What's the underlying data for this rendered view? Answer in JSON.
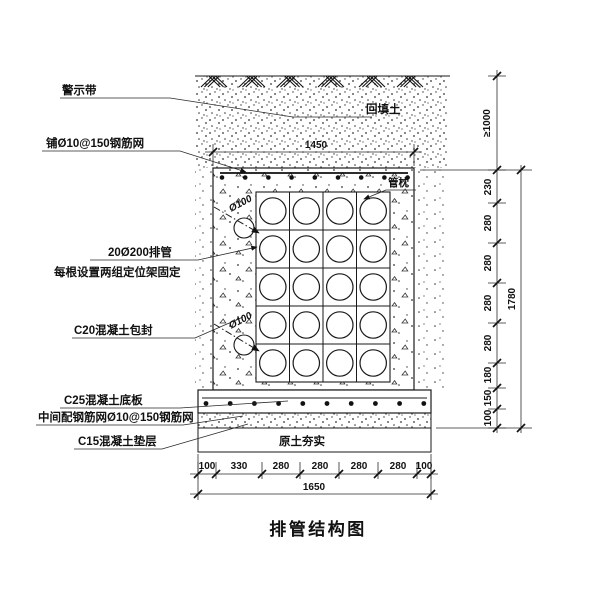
{
  "drawing_title": "排管结构图",
  "ink_color": "#1a1a1a",
  "paper_color": "#ffffff",
  "labels": {
    "warning_tape": "警示带",
    "top_mesh": "铺Ø10@150钢筋网",
    "pipes_line1": "20Ø200排管",
    "pipes_line2": "每根设置两组定位架固定",
    "encasement": "C20混凝土包封",
    "base_slab": "C25混凝土底板",
    "slab_mesh": "中间配钢筋网Ø10@150钢筋网",
    "cushion": "C15混凝土垫层",
    "backfill_soil": "回填土",
    "pipe_pillow": "管枕",
    "subgrade": "原土夯实",
    "pipe_diameter": "Ø100"
  },
  "dimensions": {
    "top_width": "1450",
    "bottom_total": "1650",
    "right_total": "1780",
    "cover_depth": "≥1000",
    "bottom_segments": [
      "100",
      "330",
      "280",
      "280",
      "280",
      "280",
      "100"
    ],
    "right_segments": [
      "230",
      "280",
      "280",
      "280",
      "280",
      "180",
      "150",
      "100"
    ]
  }
}
